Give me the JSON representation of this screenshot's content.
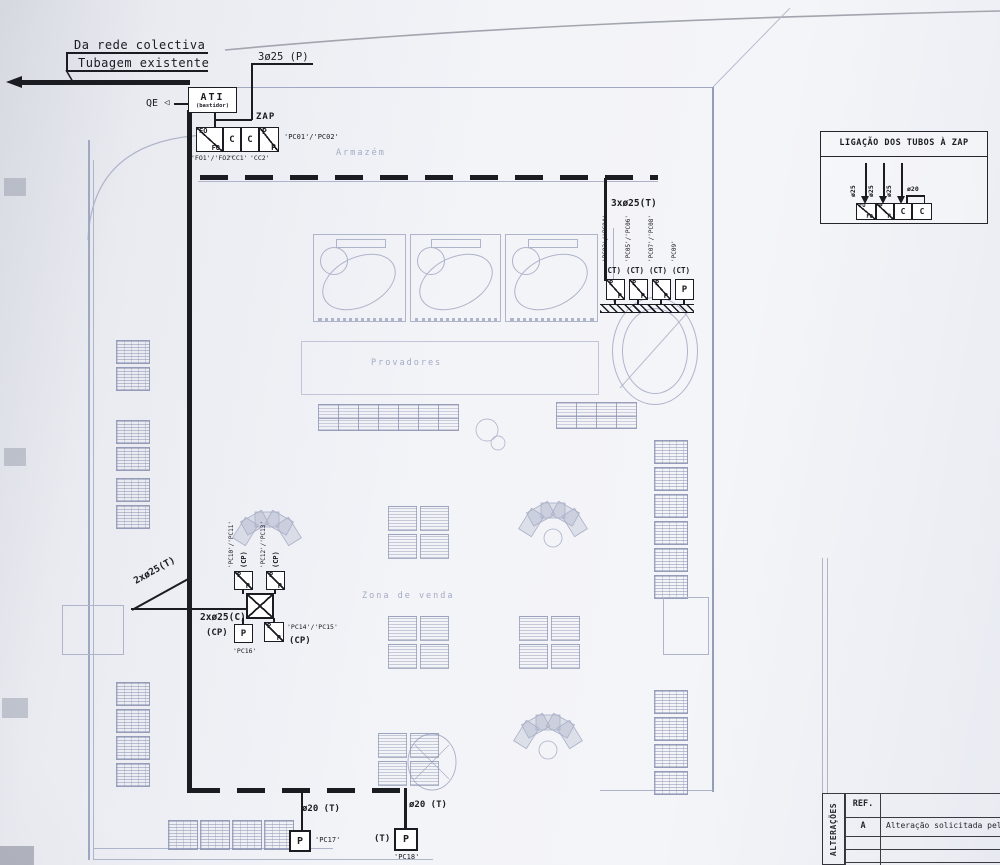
{
  "incoming": {
    "collective_label": "Da rede colectiva",
    "existing_label": "Tubagem existente",
    "riser_tube": "3ø25 (P)",
    "qe": "QE",
    "qe_arrow": "◁"
  },
  "ati": {
    "name": "ATI",
    "sub": "(bastidor)"
  },
  "zap": {
    "title": "ZAP",
    "box_fo_top": "FO",
    "box_fo_bottom": "FO",
    "box_c1": "C",
    "box_c2": "C",
    "box_p_top": "P",
    "box_p_bottom": "P",
    "label_fo": "'FO1'/'FO2'",
    "label_c1": "'CC1'",
    "label_c2": "'CC2'",
    "label_right": "'PC01'/'PC02'"
  },
  "legend": {
    "title": "LIGAÇÃO DOS TUBOS À ZAP",
    "tubes": [
      "ø25",
      "ø25",
      "ø25",
      "ø20"
    ],
    "box1_top": "FO",
    "box1_bottom": "FO",
    "box2_top": "P",
    "box2_bottom": "P",
    "box3": "C",
    "box4": "C"
  },
  "ct_branch": {
    "tube": "3xø25(T)",
    "outlets": [
      {
        "circuit": "(CT)",
        "id": "'PC03'/'PC04'",
        "top": "P",
        "bottom": "P"
      },
      {
        "circuit": "(CT)",
        "id": "'PC05'/'PC06'",
        "top": "P",
        "bottom": "P"
      },
      {
        "circuit": "(CT)",
        "id": "'PC07'/'PC08'",
        "top": "P",
        "bottom": "P"
      },
      {
        "circuit": "(CT)",
        "id": "'PC09'",
        "letter": "P"
      }
    ]
  },
  "cp_junction": {
    "tube_t": "2xø25(T)",
    "tube_c": "2xø25(C)",
    "top_left": {
      "id": "'PC10'/'PC11'",
      "circuit": "(CP)",
      "top": "P",
      "bottom": "P"
    },
    "top_right": {
      "id": "'PC12'/'PC13'",
      "circuit": "(CP)",
      "top": "P",
      "bottom": "P"
    },
    "bottom_left": {
      "circuit": "(CP)",
      "letter": "P",
      "id": "'PC16'"
    },
    "bottom_right": {
      "id": "'PC14'/'PC15'",
      "circuit": "(CP)",
      "top": "P",
      "bottom": "P"
    }
  },
  "drops": {
    "left": {
      "tube": "ø20 (T)",
      "letter": "P",
      "id": "'PC17'"
    },
    "right": {
      "tube": "ø20 (T)",
      "mark": "(T)",
      "letter": "P",
      "id": "'PC18'"
    }
  },
  "plan": {
    "storage": "Armazém",
    "fitting": "Provadores",
    "sales": "Zona de venda"
  },
  "title_block": {
    "side": "ALTERAÇÕES",
    "ref": "REF.",
    "row_ref": "A",
    "row_desc": "Alteração solicitada pela Triumph"
  },
  "colors": {
    "ink": "#1b1b22",
    "faint_plan": "#aeb4ca"
  }
}
